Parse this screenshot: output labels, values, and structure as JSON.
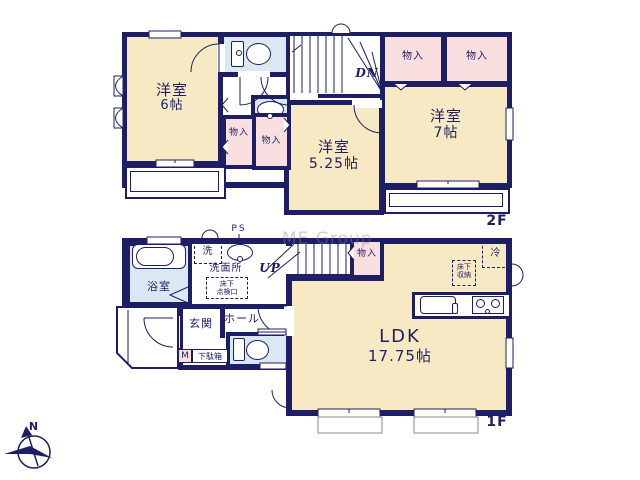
{
  "colors": {
    "wall": "#1e1e64",
    "room": "#f8e9c5",
    "closet": "#fadfe1",
    "wet": "#d9e8f3"
  },
  "watermark": "ME Group",
  "compass": {
    "north": "N"
  },
  "floor2": {
    "floor_label": "2F",
    "stairs_label": "DN",
    "room_west": {
      "name": "洋室",
      "size": "6帖"
    },
    "room_center": {
      "name": "洋室",
      "size": "5.25帖"
    },
    "room_east": {
      "name": "洋室",
      "size": "7帖"
    },
    "closet_ne_1": "物入",
    "closet_ne_2": "物入",
    "closet_mid_1": "物入",
    "closet_mid_2": "物入"
  },
  "floor1": {
    "floor_label": "1F",
    "stairs_label": "UP",
    "ldk": {
      "name": "LDK",
      "size": "17.75帖"
    },
    "entrance": "玄関",
    "hall": "ホール",
    "bathroom": "浴室",
    "washroom": "洗面所",
    "washer": "洗",
    "pipe_space": "PS",
    "underfloor_hatch": {
      "line1": "床下",
      "line2": "点検口"
    },
    "underfloor_storage": {
      "line1": "床下",
      "line2": "収納"
    },
    "fridge": "冷",
    "closet": "物入",
    "meter": "M",
    "shoe_box": "下駄箱"
  }
}
